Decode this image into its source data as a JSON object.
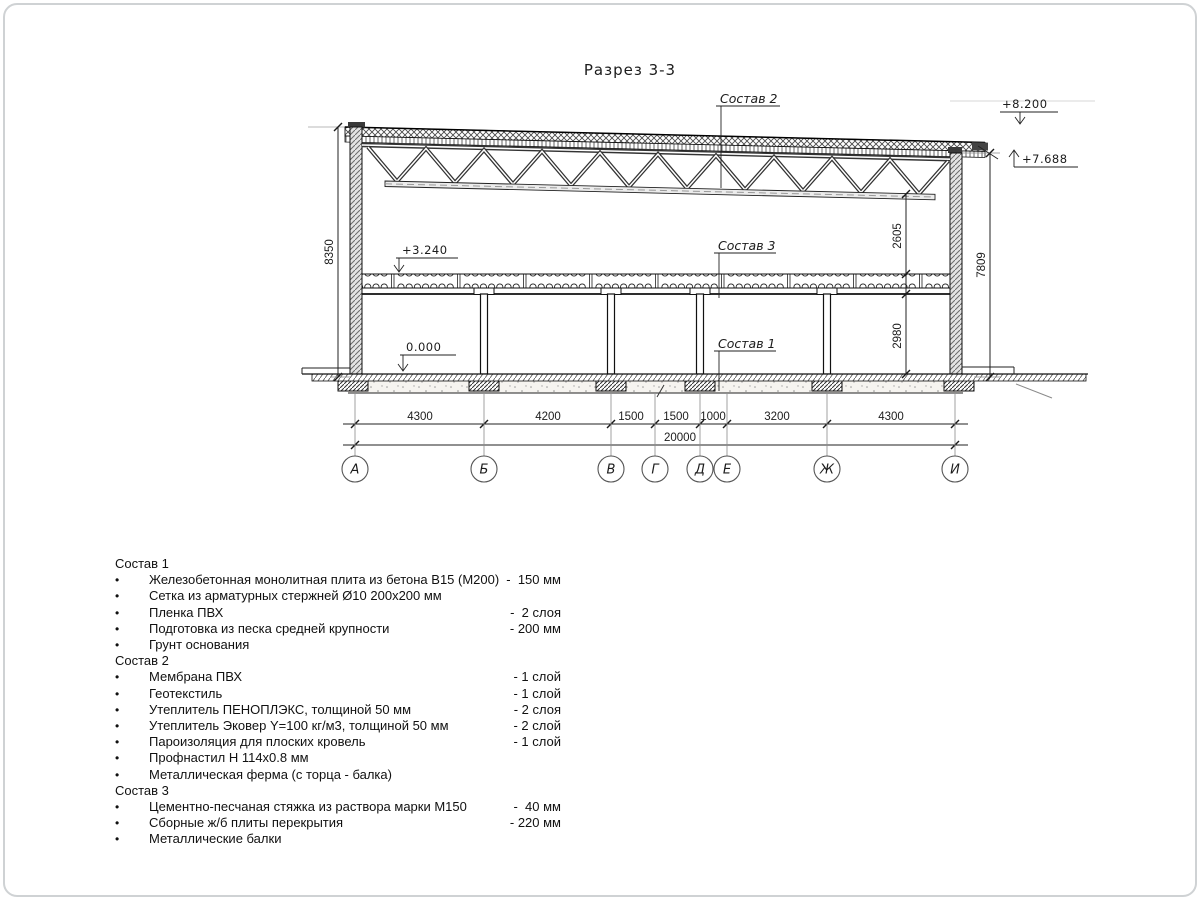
{
  "title": "Разрез 3-3",
  "drawing": {
    "elevation_roof_top": "+8.200",
    "elevation_roof_eave": "+7.688",
    "elevation_floor2": "+3.240",
    "elevation_ground": "0.000",
    "leader_roof": "Состав 2",
    "leader_floor2": "Состав 3",
    "leader_ground": "Состав 1",
    "dim_height_left": "8350",
    "dim_height_right": "7809",
    "dim_truss_zone": "2605",
    "dim_storey": "2980",
    "dim_total": "20000",
    "dim_segments": [
      "4300",
      "4200",
      "1500",
      "1500",
      "1000",
      "3200",
      "4300"
    ],
    "axes": [
      "А",
      "Б",
      "В",
      "Г",
      "Д",
      "Е",
      "Ж",
      "И"
    ]
  },
  "specs": [
    {
      "header": "Состав 1",
      "items": [
        {
          "text": "Железобетонная монолитная плита из бетона В15 (М200)",
          "qty": "-  150 мм"
        },
        {
          "text": "Сетка из арматурных стержней Ø10 200х200 мм",
          "qty": ""
        },
        {
          "text": "Пленка ПВХ",
          "qty": "-  2 слоя"
        },
        {
          "text": "Подготовка из песка средней крупности",
          "qty": "- 200 мм"
        },
        {
          "text": "Грунт основания",
          "qty": ""
        }
      ]
    },
    {
      "header": "Состав 2",
      "items": [
        {
          "text": "Мембрана ПВХ",
          "qty": "- 1 слой"
        },
        {
          "text": "Геотекстиль",
          "qty": "- 1 слой"
        },
        {
          "text": "Утеплитель ПЕНОПЛЭКС, толщиной 50 мм",
          "qty": "- 2 слоя"
        },
        {
          "text": "Утеплитель Эковер Y=100 кг/м3, толщиной 50 мм",
          "qty": "- 2 слой"
        },
        {
          "text": "Пароизоляция для плоских кровель",
          "qty": "- 1 слой"
        },
        {
          "text": "Профнастил Н 114х0.8 мм",
          "qty": ""
        },
        {
          "text": "Металлическая ферма (с торца - балка)",
          "qty": ""
        }
      ]
    },
    {
      "header": "Состав 3",
      "items": [
        {
          "text": "Цементно-песчаная стяжка из раствора марки М150",
          "qty": "-  40 мм"
        },
        {
          "text": "Сборные ж/б плиты перекрытия",
          "qty": "- 220 мм"
        },
        {
          "text": "Металлические балки",
          "qty": ""
        }
      ]
    }
  ]
}
